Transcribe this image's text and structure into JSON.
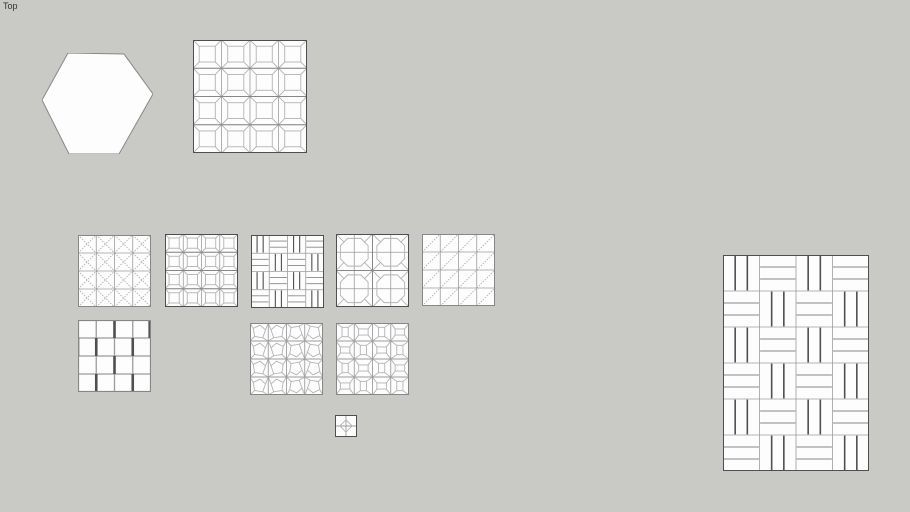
{
  "viewport": {
    "label": "Top"
  },
  "colors": {
    "background": "#c9c9c6",
    "tile_fill": "#fdfdfd",
    "edge_dark": "#4f4f4f",
    "edge_mid": "#878787",
    "edge_light": "#b3b3b3",
    "grid": "#9c9c9c",
    "label_text": "#333333"
  },
  "shapes": [
    {
      "name": "hexagon-tile",
      "type": "hexagon",
      "x": 42,
      "y": 53,
      "w": 111,
      "h": 101,
      "points": [
        [
          26,
          0
        ],
        [
          82,
          1
        ],
        [
          111,
          41
        ],
        [
          77,
          101
        ],
        [
          27,
          101
        ],
        [
          0,
          47
        ]
      ]
    },
    {
      "name": "coffered-panel-large",
      "type": "coffer",
      "x": 193,
      "y": 40,
      "w": 114,
      "h": 113,
      "cols": 4,
      "rows": 4,
      "inset": 0.22
    },
    {
      "name": "diagonal-cross-panel",
      "type": "diag_cross",
      "x": 78,
      "y": 235,
      "w": 73,
      "h": 72,
      "cols": 4,
      "rows": 4
    },
    {
      "name": "coffered-panel-small",
      "type": "coffer",
      "x": 165,
      "y": 234,
      "w": 73,
      "h": 73,
      "cols": 4,
      "rows": 4,
      "inset": 0.22
    },
    {
      "name": "basketweave-panel-small",
      "type": "basketweave",
      "x": 251,
      "y": 235,
      "w": 73,
      "h": 73,
      "cols": 4,
      "rows": 4,
      "planks": 3
    },
    {
      "name": "octagon-coffer-panel",
      "type": "octagon_cross",
      "x": 336,
      "y": 234,
      "w": 73,
      "h": 73,
      "cols": 2,
      "rows": 2
    },
    {
      "name": "single-diagonal-panel",
      "type": "diag_single",
      "x": 422,
      "y": 234,
      "w": 73,
      "h": 72,
      "cols": 4,
      "rows": 4
    },
    {
      "name": "offset-squares-panel",
      "type": "offset_squares",
      "x": 78,
      "y": 320,
      "w": 73,
      "h": 72,
      "cols": 4,
      "rows": 4,
      "dark_v": [
        [
          2,
          4
        ],
        [
          0,
          1,
          3
        ],
        [
          2
        ],
        [
          1,
          3
        ]
      ]
    },
    {
      "name": "stone-pattern-panel",
      "type": "stone",
      "x": 250,
      "y": 323,
      "w": 73,
      "h": 72,
      "cols": 4,
      "rows": 4
    },
    {
      "name": "frustum-pattern-panel",
      "type": "frustum",
      "x": 336,
      "y": 323,
      "w": 73,
      "h": 72,
      "cols": 4,
      "rows": 4
    },
    {
      "name": "small-quad-diamond-tile",
      "type": "quad_diamond",
      "x": 335,
      "y": 415,
      "w": 22,
      "h": 22
    },
    {
      "name": "basketweave-panel-large",
      "type": "basketweave",
      "x": 723,
      "y": 255,
      "w": 146,
      "h": 216,
      "cols": 4,
      "rows": 6,
      "planks": 3
    }
  ]
}
